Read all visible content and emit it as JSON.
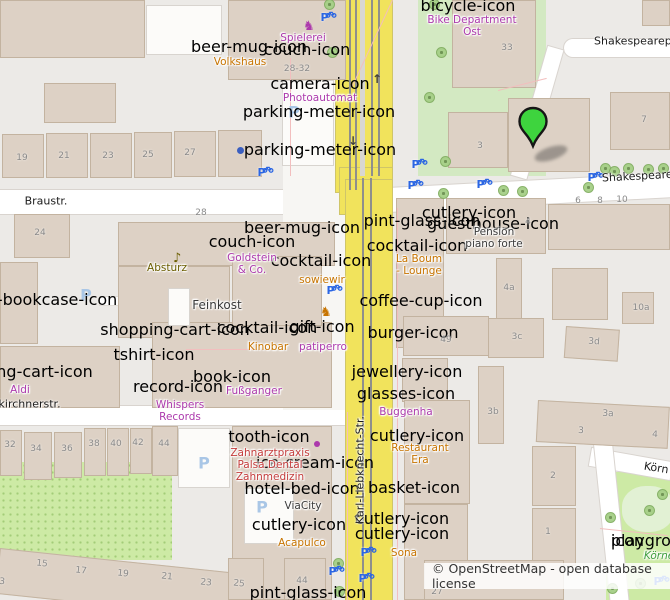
{
  "map": {
    "attribution": {
      "text": "© OpenStreetMap - open database license"
    },
    "marker": {
      "x": 533,
      "y": 158
    },
    "colors": {
      "purple": "#ac39ac",
      "amber": "#c77400",
      "olive": "#6b5e00",
      "dark": "#3a3a3a",
      "red": "#c43c3c",
      "green": "#3f9e3f",
      "blue": "#2b66e3",
      "lightblue": "#a9c6e6",
      "brown": "#7a5b2e",
      "steel": "#6f94c4",
      "dotblue": "#3b5fc0",
      "marker_green": "#3ed43e",
      "road_yellow": "#f1e35c"
    },
    "streets": [
      {
        "text": "Braustr.",
        "x": 46,
        "y": 201
      },
      {
        "text": "rkirchnerstr.",
        "x": -6,
        "y": 404,
        "anchor": "left"
      },
      {
        "text": "Shakespearep",
        "x": 594,
        "y": 41,
        "anchor": "left"
      },
      {
        "text": "Shakespeare",
        "x": 602,
        "y": 178,
        "anchor": "left",
        "rot": -3
      },
      {
        "text": "Karl-Liebknecht-Str.",
        "x": 360,
        "y": 470,
        "rot": -90
      },
      {
        "text": "Körn",
        "x": 644,
        "y": 466,
        "anchor": "left",
        "rot": 9
      }
    ],
    "pois": [
      {
        "lines": [
          "Spielerei"
        ],
        "x": 303,
        "y": 38,
        "color": "purple"
      },
      {
        "lines": [
          "Volkshaus"
        ],
        "x": 240,
        "y": 62,
        "color": "amber"
      },
      {
        "lines": [
          "Photoautomat"
        ],
        "x": 320,
        "y": 98,
        "color": "purple"
      },
      {
        "lines": [
          "Bike Department",
          "Ost"
        ],
        "x": 472,
        "y": 26,
        "color": "purple"
      },
      {
        "lines": [
          "Absturz"
        ],
        "x": 167,
        "y": 268,
        "color": "olive"
      },
      {
        "lines": [
          "Goldstein",
          "& Co."
        ],
        "x": 252,
        "y": 264,
        "color": "purple"
      },
      {
        "lines": [
          "sowiewir"
        ],
        "x": 322,
        "y": 280,
        "color": "amber"
      },
      {
        "lines": [
          "Feinkost"
        ],
        "x": 217,
        "y": 305,
        "color": "dark",
        "size": 12
      },
      {
        "lines": [
          "Kinobar"
        ],
        "x": 268,
        "y": 347,
        "color": "amber"
      },
      {
        "lines": [
          "patiperro"
        ],
        "x": 323,
        "y": 347,
        "color": "purple"
      },
      {
        "lines": [
          "Aldi"
        ],
        "x": 20,
        "y": 390,
        "color": "purple"
      },
      {
        "lines": [
          "Whispers",
          "Records"
        ],
        "x": 180,
        "y": 411,
        "color": "purple"
      },
      {
        "lines": [
          "Fußganger"
        ],
        "x": 254,
        "y": 391,
        "color": "purple"
      },
      {
        "lines": [
          "La Boum",
          "- Lounge"
        ],
        "x": 419,
        "y": 265,
        "color": "amber"
      },
      {
        "lines": [
          "Pension",
          "piano forte"
        ],
        "x": 494,
        "y": 238,
        "color": "dark"
      },
      {
        "lines": [
          "Buggenha"
        ],
        "x": 406,
        "y": 412,
        "color": "purple"
      },
      {
        "lines": [
          "Restaurant",
          "Era"
        ],
        "x": 420,
        "y": 454,
        "color": "amber"
      },
      {
        "lines": [
          "Sona"
        ],
        "x": 404,
        "y": 553,
        "color": "amber"
      },
      {
        "lines": [
          "Acapulco"
        ],
        "x": 302,
        "y": 543,
        "color": "amber"
      },
      {
        "lines": [
          "Zahnarztpraxis",
          "Palsa Dental",
          "Zahnmedizin"
        ],
        "x": 270,
        "y": 465,
        "color": "red"
      },
      {
        "lines": [
          "ViaCity"
        ],
        "x": 303,
        "y": 506,
        "color": "dark"
      },
      {
        "lines": [
          "Körne"
        ],
        "x": 659,
        "y": 556,
        "color": "green",
        "italic": true
      }
    ],
    "numbers": [
      {
        "t": "19",
        "x": 22,
        "y": 158
      },
      {
        "t": "21",
        "x": 64,
        "y": 156
      },
      {
        "t": "23",
        "x": 108,
        "y": 156
      },
      {
        "t": "25",
        "x": 148,
        "y": 155
      },
      {
        "t": "27",
        "x": 190,
        "y": 153
      },
      {
        "t": "28-32",
        "x": 297,
        "y": 69
      },
      {
        "t": "33",
        "x": 507,
        "y": 48
      },
      {
        "t": "7",
        "x": 644,
        "y": 120
      },
      {
        "t": "3",
        "x": 480,
        "y": 146
      },
      {
        "t": "6",
        "x": 578,
        "y": 201
      },
      {
        "t": "8",
        "x": 600,
        "y": 201
      },
      {
        "t": "10",
        "x": 622,
        "y": 200
      },
      {
        "t": "28",
        "x": 201,
        "y": 213
      },
      {
        "t": "24",
        "x": 40,
        "y": 233
      },
      {
        "t": "4",
        "x": 528,
        "y": 222
      },
      {
        "t": "4a",
        "x": 509,
        "y": 288
      },
      {
        "t": "10a",
        "x": 641,
        "y": 308
      },
      {
        "t": "3c",
        "x": 517,
        "y": 337
      },
      {
        "t": "3d",
        "x": 594,
        "y": 342,
        "rot": 4
      },
      {
        "t": "49",
        "x": 446,
        "y": 340
      },
      {
        "t": "3b",
        "x": 493,
        "y": 412
      },
      {
        "t": "3a",
        "x": 608,
        "y": 414,
        "rot": 3
      },
      {
        "t": "3",
        "x": 581,
        "y": 431,
        "rot": 3
      },
      {
        "t": "4",
        "x": 655,
        "y": 435,
        "rot": 3
      },
      {
        "t": "2",
        "x": 553,
        "y": 476
      },
      {
        "t": "1",
        "x": 548,
        "y": 532
      },
      {
        "t": "32",
        "x": 10,
        "y": 445
      },
      {
        "t": "34",
        "x": 36,
        "y": 449
      },
      {
        "t": "36",
        "x": 67,
        "y": 449
      },
      {
        "t": "38",
        "x": 94,
        "y": 444
      },
      {
        "t": "40",
        "x": 116,
        "y": 444
      },
      {
        "t": "42",
        "x": 138,
        "y": 443
      },
      {
        "t": "44",
        "x": 164,
        "y": 444
      },
      {
        "t": "3",
        "x": 2,
        "y": 582,
        "rot": 6
      },
      {
        "t": "15",
        "x": 42,
        "y": 564,
        "rot": 6
      },
      {
        "t": "17",
        "x": 81,
        "y": 571,
        "rot": 6
      },
      {
        "t": "19",
        "x": 123,
        "y": 574,
        "rot": 6
      },
      {
        "t": "21",
        "x": 167,
        "y": 577,
        "rot": 6
      },
      {
        "t": "23",
        "x": 206,
        "y": 583,
        "rot": 6
      },
      {
        "t": "25",
        "x": 239,
        "y": 584,
        "rot": 6
      },
      {
        "t": "44",
        "x": 302,
        "y": 581
      },
      {
        "t": "27",
        "x": 437,
        "y": 592
      }
    ],
    "icons": [
      {
        "name": "beer-mug-icon",
        "x": 249,
        "y": 47,
        "color": "amber"
      },
      {
        "name": "beer-mug-icon",
        "x": 302,
        "y": 228,
        "color": "amber"
      },
      {
        "name": "pint-glass-icon",
        "x": 422,
        "y": 221,
        "color": "amber"
      },
      {
        "name": "pint-glass-icon",
        "x": 308,
        "y": 593,
        "color": "amber"
      },
      {
        "name": "cocktail-icon",
        "x": 321,
        "y": 261,
        "color": "amber"
      },
      {
        "name": "cocktail-icon",
        "x": 267,
        "y": 328,
        "color": "amber"
      },
      {
        "name": "cocktail-icon",
        "x": 417,
        "y": 246,
        "color": "amber"
      },
      {
        "name": "coffee-cup-icon",
        "x": 421,
        "y": 301,
        "color": "amber"
      },
      {
        "name": "cutlery-icon",
        "x": 469,
        "y": 213,
        "color": "amber"
      },
      {
        "name": "cutlery-icon",
        "x": 417,
        "y": 436,
        "color": "amber"
      },
      {
        "name": "cutlery-icon",
        "x": 299,
        "y": 525,
        "color": "amber"
      },
      {
        "name": "cutlery-icon",
        "x": 402,
        "y": 519,
        "color": "amber"
      },
      {
        "name": "cutlery-icon",
        "x": 402,
        "y": 534,
        "color": "amber"
      },
      {
        "name": "burger-icon",
        "x": 413,
        "y": 333,
        "color": "amber"
      },
      {
        "name": "basket-icon",
        "x": 414,
        "y": 488,
        "color": "purple"
      },
      {
        "name": "guesthouse-icon",
        "x": 493,
        "y": 224,
        "color": "dark"
      },
      {
        "name": "hotel-bed-icon",
        "x": 302,
        "y": 489,
        "color": "dark"
      },
      {
        "name": "camera-icon",
        "x": 320,
        "y": 84,
        "color": "purple"
      },
      {
        "name": "rocking-horse-icon",
        "x": 303,
        "y": 20,
        "color": "purple"
      },
      {
        "name": "rocking-horse-icon",
        "x": 320,
        "y": 306,
        "color": "amber"
      },
      {
        "name": "couch-icon",
        "x": 307,
        "y": 50,
        "color": "purple"
      },
      {
        "name": "couch-icon",
        "x": 252,
        "y": 242,
        "color": "purple"
      },
      {
        "name": "music-note-icon",
        "x": 173,
        "y": 252,
        "color": "olive"
      },
      {
        "name": "record-icon",
        "x": 178,
        "y": 387,
        "color": "purple"
      },
      {
        "name": "book-icon",
        "x": 232,
        "y": 377,
        "color": "purple"
      },
      {
        "name": "tshirt-icon",
        "x": 154,
        "y": 355,
        "color": "purple"
      },
      {
        "name": "gift-icon",
        "x": 322,
        "y": 327,
        "color": "purple"
      },
      {
        "name": "tooth-icon",
        "x": 269,
        "y": 437,
        "color": "red"
      },
      {
        "name": "glasses-icon",
        "x": 406,
        "y": 394,
        "color": "purple"
      },
      {
        "name": "jewellery-icon",
        "x": 407,
        "y": 372,
        "color": "purple"
      },
      {
        "name": "shopping-cart-icon",
        "x": 18,
        "y": 372,
        "color": "purple"
      },
      {
        "name": "shopping-cart-icon",
        "x": 175,
        "y": 330,
        "color": "purple"
      },
      {
        "name": "bicycle-icon",
        "x": 468,
        "y": 6,
        "color": "purple"
      },
      {
        "name": "ice-cream-icon",
        "x": 315,
        "y": 463,
        "color": "amber"
      },
      {
        "name": "public-bookcase-icon",
        "x": 33,
        "y": 300,
        "color": "brown"
      },
      {
        "name": "parking-meter-icon",
        "x": 319,
        "y": 112,
        "color": "steel"
      },
      {
        "name": "parking-meter-icon",
        "x": 320,
        "y": 150,
        "color": "steel"
      },
      {
        "name": "playground-icon",
        "x": 659,
        "y": 541,
        "color": "green"
      }
    ],
    "bike_parking": [
      [
        329,
        21
      ],
      [
        266,
        176
      ],
      [
        420,
        168
      ],
      [
        416,
        189
      ],
      [
        485,
        188
      ],
      [
        596,
        181
      ],
      [
        335,
        294
      ],
      [
        369,
        556
      ],
      [
        337,
        575
      ],
      [
        367,
        582
      ],
      [
        662,
        585
      ]
    ],
    "area_parking": [
      [
        294,
        112
      ],
      [
        86,
        295
      ],
      [
        204,
        463
      ],
      [
        262,
        507
      ]
    ],
    "poi_dots": [
      {
        "x": 240,
        "y": 150,
        "color": "dotblue",
        "r": 3.5
      },
      {
        "x": 317,
        "y": 444,
        "color": "purple",
        "r": 3
      }
    ],
    "road_arrows": [
      {
        "g": "↑",
        "x": 377,
        "y": 79
      },
      {
        "g": "↓",
        "x": 353,
        "y": 141
      },
      {
        "g": "↑",
        "x": 357,
        "y": 519
      }
    ],
    "trees": [
      [
        329,
        4
      ],
      [
        332,
        52
      ],
      [
        434,
        4
      ],
      [
        441,
        52
      ],
      [
        429,
        97
      ],
      [
        445,
        161
      ],
      [
        443,
        193
      ],
      [
        503,
        190
      ],
      [
        522,
        191
      ],
      [
        588,
        187
      ],
      [
        605,
        168
      ],
      [
        614,
        171
      ],
      [
        628,
        168
      ],
      [
        648,
        169
      ],
      [
        663,
        168
      ],
      [
        338,
        563
      ],
      [
        339,
        591
      ],
      [
        610,
        517
      ],
      [
        649,
        510
      ],
      [
        640,
        583
      ],
      [
        612,
        588
      ],
      [
        662,
        494
      ]
    ]
  }
}
